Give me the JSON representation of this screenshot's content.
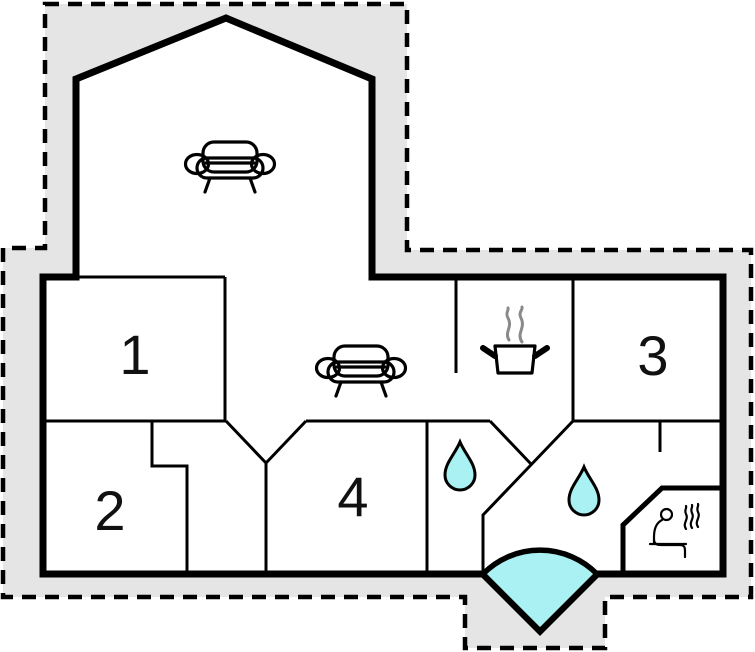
{
  "colors": {
    "background": "#ffffff",
    "site_fill": "#e5e5e5",
    "water_fill": "#a9f1f2",
    "wall": "#000000",
    "steam": "#8a8a8a",
    "label": "#111111"
  },
  "floor_plan": {
    "rooms": [
      {
        "label": "1"
      },
      {
        "label": "2"
      },
      {
        "label": "3"
      },
      {
        "label": "4"
      }
    ],
    "icons": [
      {
        "name": "sofa-icon",
        "area": "gable-lounge"
      },
      {
        "name": "sofa-icon",
        "area": "living-area"
      },
      {
        "name": "steaming-pot-icon",
        "area": "kitchen-area"
      },
      {
        "name": "water-drop-icon",
        "area": "washroom-left"
      },
      {
        "name": "water-drop-icon",
        "area": "washroom-center"
      },
      {
        "name": "sauna-person-icon",
        "area": "sauna-corner"
      },
      {
        "name": "door-swing-icon",
        "area": "entrance"
      }
    ]
  }
}
